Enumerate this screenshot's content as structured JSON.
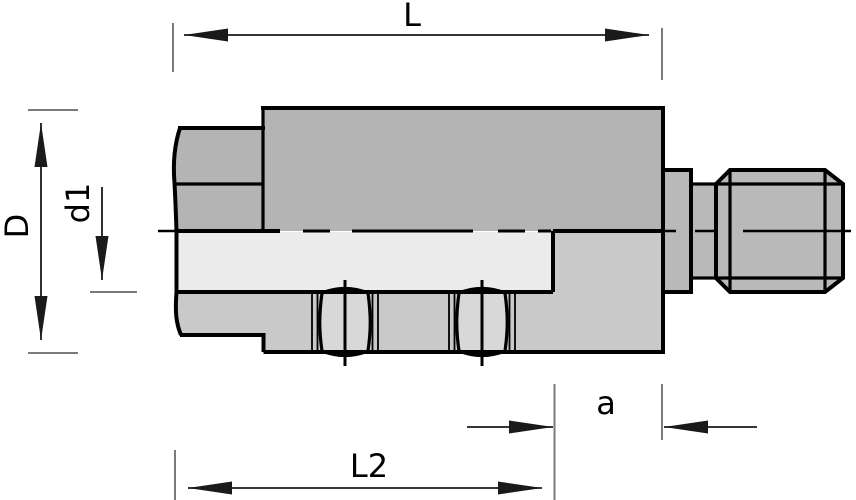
{
  "dimensions": {
    "L": {
      "label": "L"
    },
    "D": {
      "label": "D"
    },
    "d1": {
      "label": "d1"
    },
    "a": {
      "label": "a"
    },
    "L2": {
      "label": "L2"
    }
  },
  "colors": {
    "bg": "#ffffff",
    "line": "#000000",
    "dim_line": "#1a1a1a",
    "ext_line": "#7a7a7a",
    "body_upper": "#b4b4b4",
    "fitting": "#b9b9b9",
    "body_lower": "#c9c9c9",
    "bore": "#ececec",
    "crimp_band": "#d8d8d8",
    "text": "#000000"
  }
}
